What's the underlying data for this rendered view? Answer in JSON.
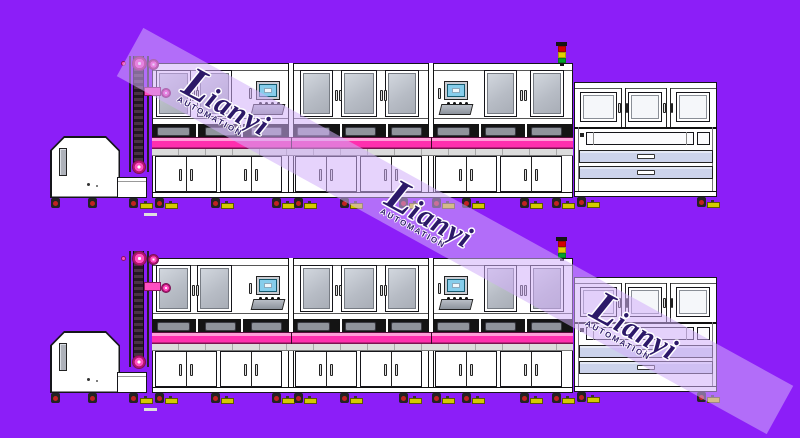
{
  "canvas": {
    "width": 800,
    "height": 438,
    "background": "#8c1ef8"
  },
  "watermark": {
    "text": "Lianyi",
    "text_initial": "L",
    "text_rest": "ianyi",
    "subtext": "AUTOMATION",
    "stripe_color": "rgba(210,175,250,0.55)",
    "text_color": "#2c1968",
    "instances": 3
  },
  "rows": [
    {
      "name": "machine-line-1"
    },
    {
      "name": "machine-line-2"
    }
  ],
  "machine_line": {
    "components": [
      "feeder-cabinet",
      "chain-elevator",
      "process-module-1",
      "process-module-2",
      "process-module-3",
      "signal-tower",
      "unload-station"
    ],
    "module_count": 3,
    "touch_panels": 2,
    "drawer_count": 2,
    "colors": {
      "conveyor": "#ff2fae",
      "conveyor_highlight": "#ff9dd8",
      "conveyor_shadow": "#7c1050",
      "window_glass": "#b7bcc5",
      "screen": "#86cdeb",
      "drawer": "#ccd3eb",
      "pulley": "#ff4fc1",
      "leveler_foot": "#d4ca00",
      "caster_hub": "#c22222",
      "signal_tower": [
        "#d40000",
        "#e3cf00",
        "#00a32a"
      ]
    }
  },
  "separators": 2
}
